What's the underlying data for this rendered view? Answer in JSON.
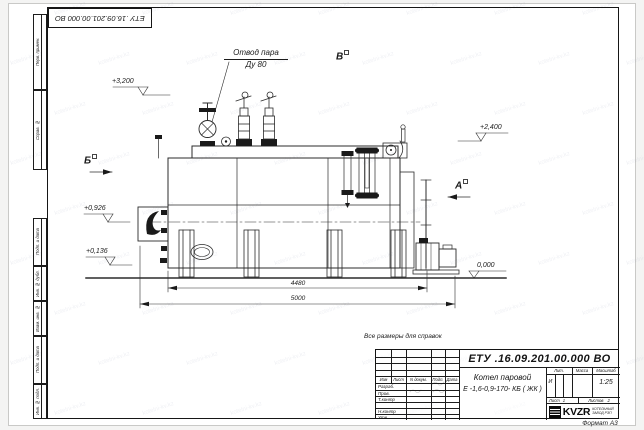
{
  "watermark": {
    "text": "kotelni-kv.kz"
  },
  "corner_stamp": {
    "doc_number": "ЕТУ .16.09.201.00.000 ВО"
  },
  "margin_stamps": [
    {
      "label": "Перв. примен."
    },
    {
      "label": "Справ. №"
    },
    {
      "label": "Подп. и дата"
    },
    {
      "label": "Инв. № дубл."
    },
    {
      "label": "Взам. инв. №"
    },
    {
      "label": "Подп. и дата"
    },
    {
      "label": "Инв. № подл."
    }
  ],
  "annotations": {
    "steam_outlet": {
      "line1": "Отвод пара",
      "line2": "Ду 80"
    },
    "sections": {
      "b": "Б",
      "v": "В",
      "a": "А"
    },
    "elevations": {
      "e3200": "+3,200",
      "e2400": "+2,400",
      "e0926": "+0,926",
      "e0136": "+0,136",
      "e0000": "0,000"
    },
    "dimensions": {
      "length_inner": "4480",
      "length_outer": "5000"
    }
  },
  "note": "Все размеры для справок",
  "title_block": {
    "doc_number": "ЕТУ .16.09.201.00.000 ВО",
    "product_line1": "Котел паровой",
    "product_line2": "Е -1,6-0,9-170- КБ ( ЖК )",
    "col_izm": "Изм",
    "col_list": "Лист",
    "col_doc": "N докум.",
    "col_podp": "Подп.",
    "col_data": "Дата",
    "row_razrab": "Разраб.",
    "row_prov": "Пров.",
    "row_tkontr": "Т.контр",
    "row_nkontr": "Н.контр",
    "row_utv": "Утв.",
    "lit_label": "Лит.",
    "mass_label": "Масса",
    "scale_label": "Масштаб",
    "lit_value": "И",
    "scale_value": "1:25",
    "sheet_label": "Лист",
    "sheet_value": "1",
    "sheets_label": "Листов",
    "sheets_value": "2",
    "logo_text": "KVZR",
    "company": "КОТЕЛЬНЫЙ ЗАВОД РЭП",
    "format": "Формат А3"
  }
}
